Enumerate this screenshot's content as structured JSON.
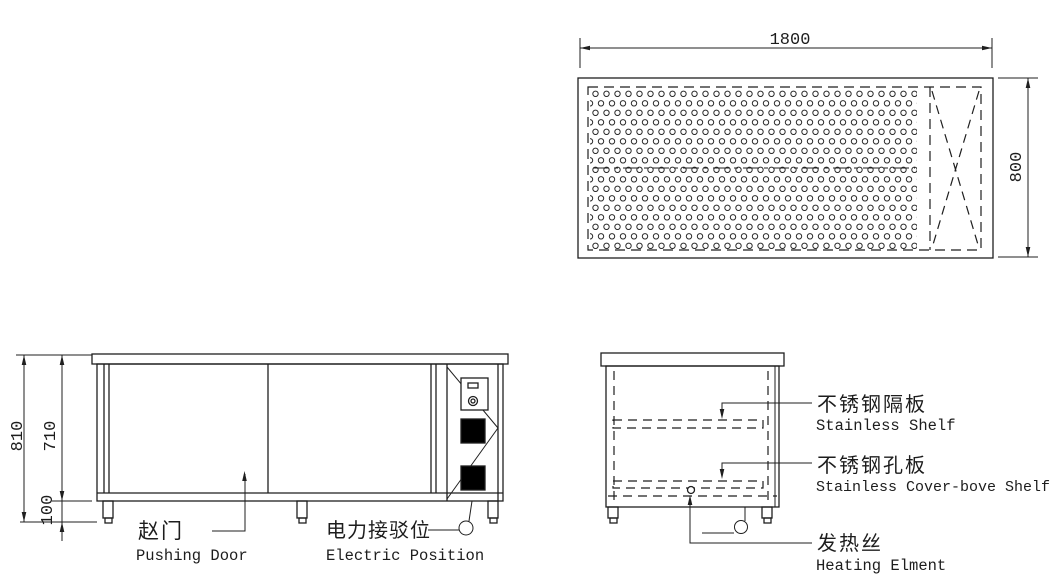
{
  "drawing": {
    "title": "stainless warming cabinet technical drawing",
    "colors": {
      "background": "#ffffff",
      "line": "#1f1f1f",
      "switch_fill": "#000000"
    },
    "top_view": {
      "width_mm": "1800",
      "depth_mm": "800"
    },
    "front_view": {
      "total_height_mm": "810",
      "body_height_mm": "710",
      "leg_height_mm": "100",
      "door_label_zh": "赵门",
      "door_label_en": "Pushing Door",
      "electric_label_zh": "电力接驳位",
      "electric_label_en": "Electric Position"
    },
    "side_view": {
      "shelf_label_zh": "不锈钢隔板",
      "shelf_label_en": "Stainless Shelf",
      "perforated_label_zh": "不锈钢孔板",
      "perforated_label_en": "Stainless Cover-bove Shelf",
      "heating_label_zh": "发热丝",
      "heating_label_en": "Heating Elment"
    }
  }
}
